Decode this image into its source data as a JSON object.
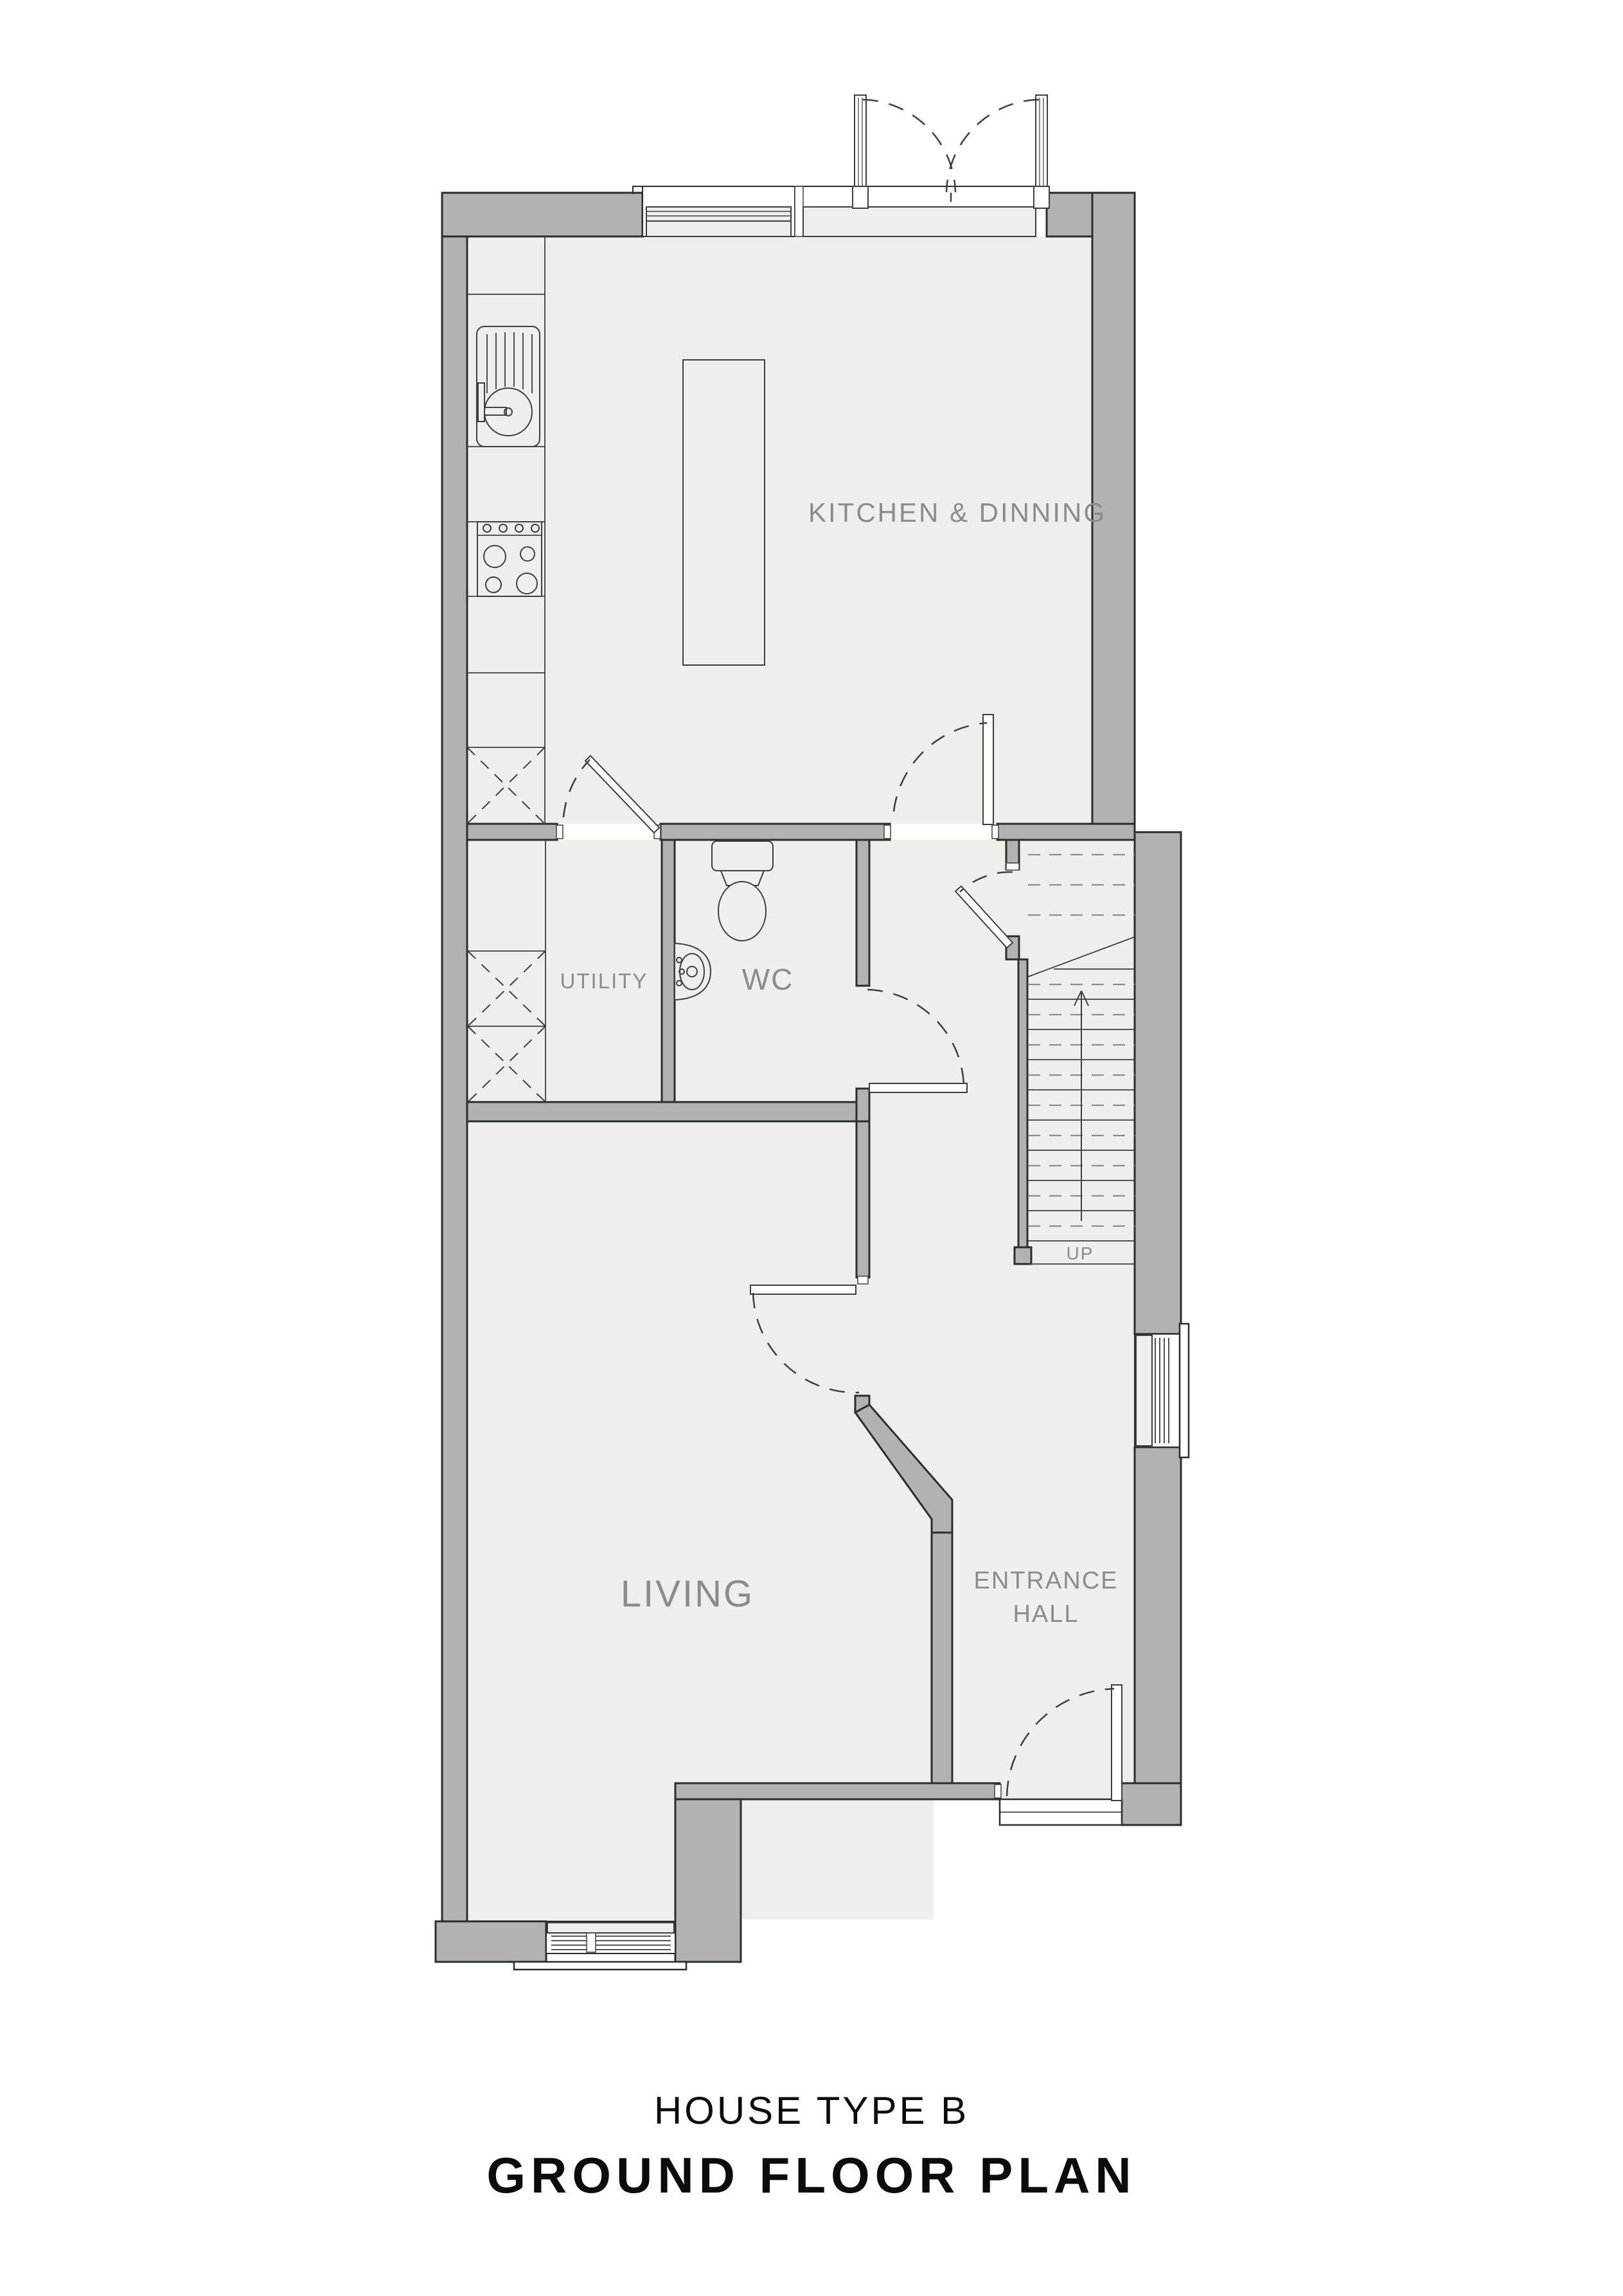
{
  "title_block": {
    "line1": "HOUSE TYPE B",
    "line2": "GROUND FLOOR PLAN"
  },
  "rooms": {
    "kitchen": {
      "label": "KITCHEN & DINNING"
    },
    "utility": {
      "label": "UTILITY"
    },
    "wc": {
      "label": "WC"
    },
    "living": {
      "label": "LIVING"
    },
    "entrance": {
      "label_line1": "ENTRANCE",
      "label_line2": "HALL"
    }
  },
  "stairs": {
    "direction_label": "UP"
  },
  "fixtures": [
    "french-doors",
    "kitchen-window",
    "kitchen-sink",
    "stove-4-burner",
    "kitchen-island",
    "utility-appliance-bays",
    "toilet",
    "wash-basin",
    "staircase-up",
    "side-window",
    "bay-window",
    "front-door"
  ],
  "colors": {
    "wall": "#b3b2b0",
    "floor": "#f0eeeb",
    "outline": "#2c2c2a",
    "fixline": "#3e3e3c",
    "label": "#8b8b88",
    "title": "#0b0b0b"
  }
}
